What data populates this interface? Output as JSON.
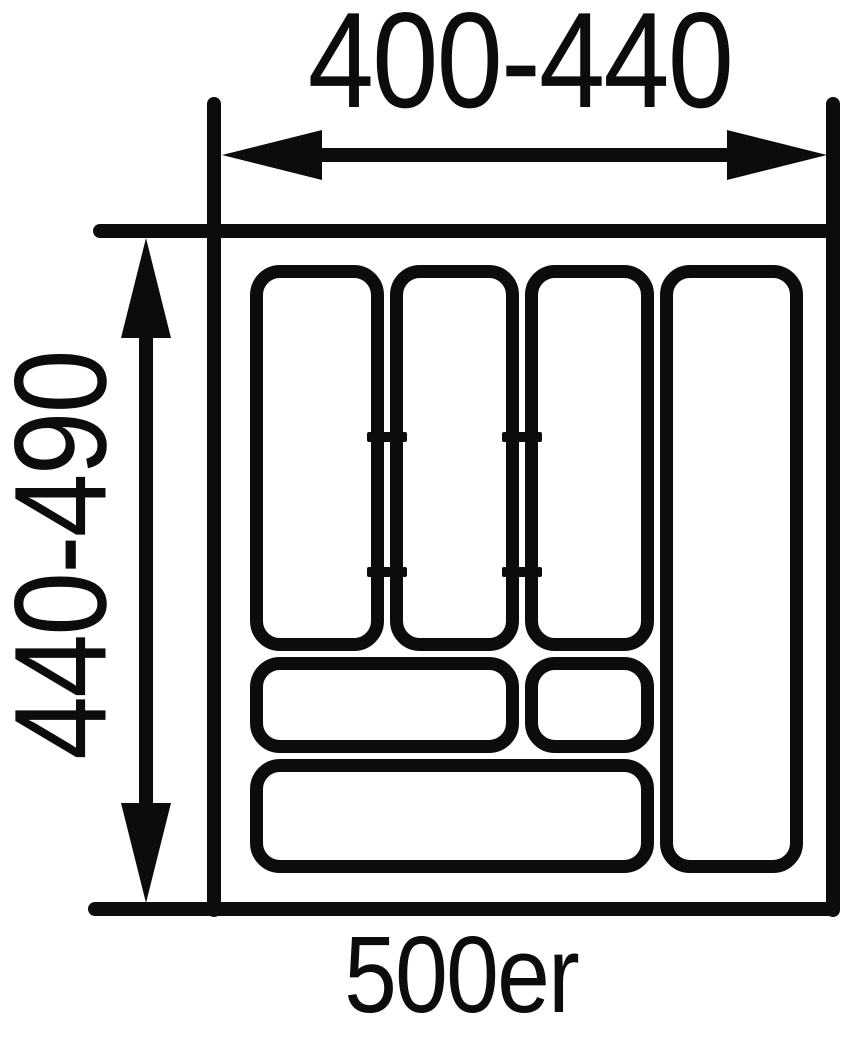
{
  "diagram": {
    "type": "technical-dimension-drawing",
    "subject": "cutlery-tray-insert-top-view",
    "width_dimension_label": "400-440",
    "height_dimension_label": "440-490",
    "size_label": "500er",
    "colors": {
      "line": "#0c0c0c",
      "background": "#ffffff"
    }
  }
}
